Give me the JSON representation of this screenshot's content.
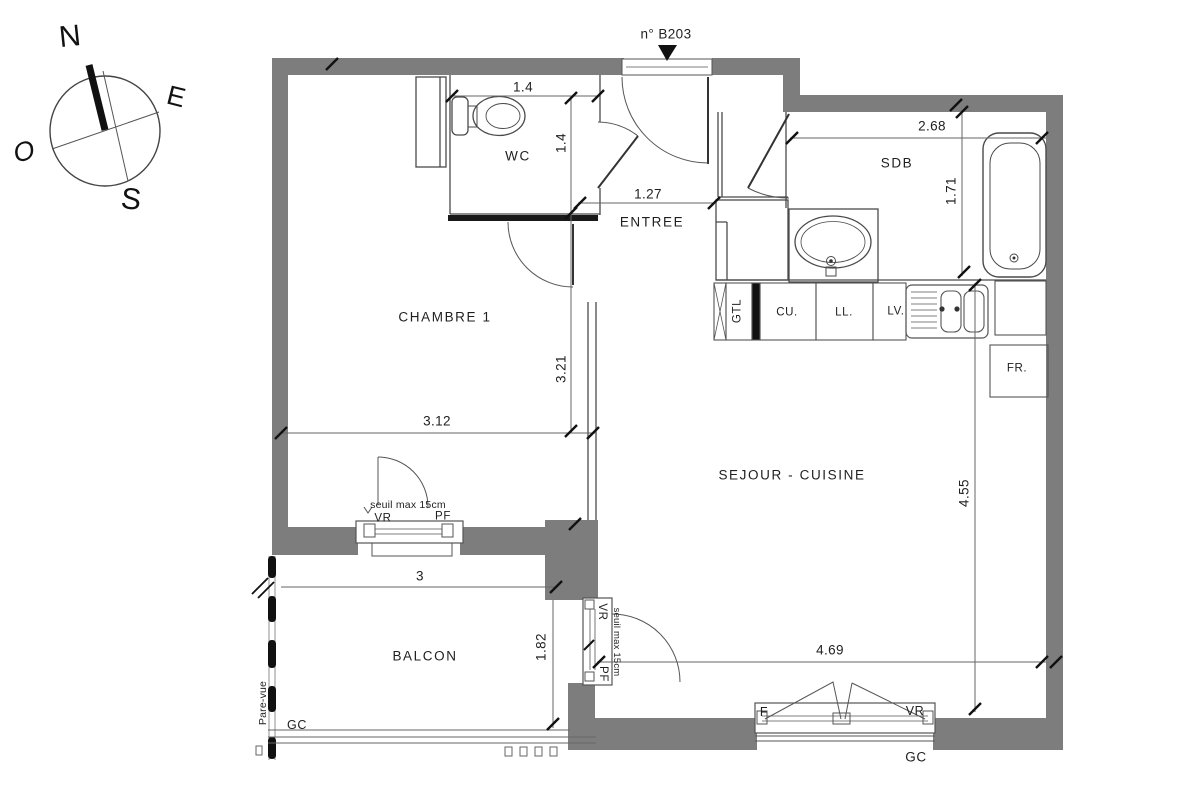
{
  "header": {
    "unit_number": "n° B203"
  },
  "compass": {
    "north": "N",
    "east": "E",
    "west": "O",
    "south": "S"
  },
  "rooms": {
    "wc": {
      "label": "WC"
    },
    "entree": {
      "label": "ENTREE"
    },
    "sdb": {
      "label": "SDB"
    },
    "chambre": {
      "label": "CHAMBRE 1"
    },
    "sejour": {
      "label": "SEJOUR - CUISINE"
    },
    "balcon": {
      "label": "BALCON"
    }
  },
  "dimensions": {
    "wc_width": "1.4",
    "wc_depth": "1.4",
    "entree_width": "1.27",
    "sdb_width": "2.68",
    "sdb_depth": "1.71",
    "chambre_depth": "3.21",
    "chambre_width": "3.12",
    "sejour_depth": "4.55",
    "sejour_width": "4.69",
    "balcon_width": "3",
    "balcon_depth": "1.82"
  },
  "kitchen": {
    "gtl": "GTL",
    "cu": "CU.",
    "ll": "LL.",
    "lv": "LV.",
    "fr": "FR."
  },
  "openings": {
    "chambre_window": {
      "note": "seuil max 15cm",
      "vr": "VR",
      "pf": "PF"
    },
    "balcon_door": {
      "vr": "VR",
      "note": "seuil max 15cm",
      "pf": "PF"
    },
    "sejour_window": {
      "f": "F",
      "vr": "VR"
    }
  },
  "annotations": {
    "pare_vue": "Pare-vue",
    "gc_balcon": "GC",
    "gc_sejour": "GC"
  },
  "colors": {
    "wall": "#7d7d7d",
    "line": "#4a4a4a",
    "dark": "#111111",
    "background": "#ffffff"
  }
}
